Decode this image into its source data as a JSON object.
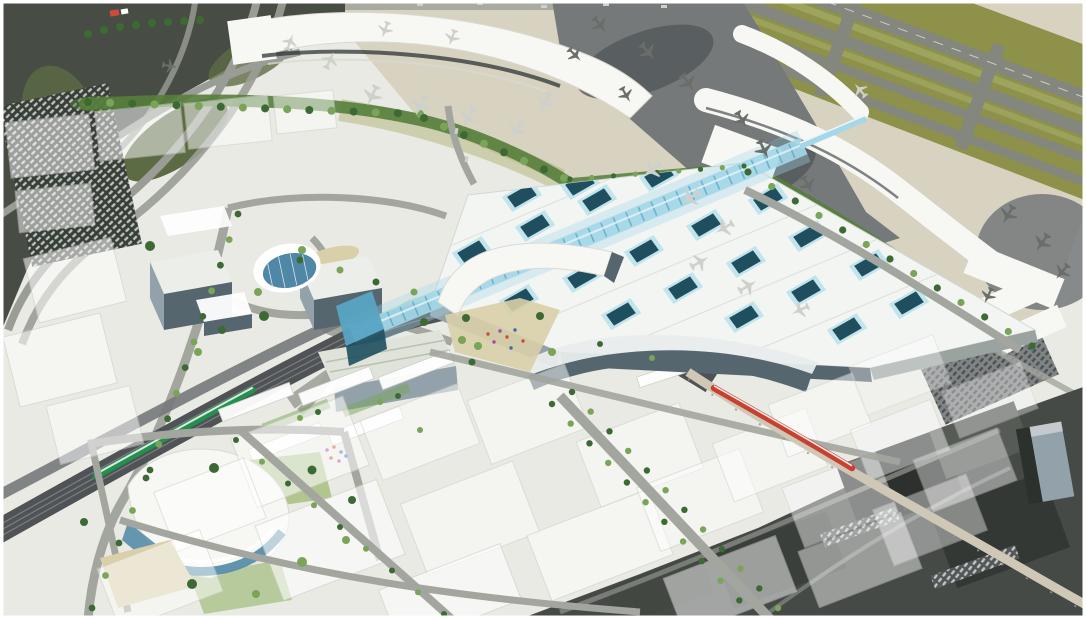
{
  "meta": {
    "description": "Aerial architectural rendering of an airport district: existing terminal piers, apron and runways across the top, a new white transit hall with a diagonal blue glass galleria spine and skylights at centre, an office campus with a round glass building at left, a rail corridor with a green commuter train and an elevated guideway with a red airport train, a curved civic landmark building at lower left, translucent future-development massing blocks and tree-lined streets below, and a darker existing industrial area photo at lower right."
  },
  "palette": {
    "photoBase": "#474c44",
    "photoRoad": "#9a9d95",
    "photoGrass": "#5d6b45",
    "photoLot": "#383e38",
    "apron": "#d8d2c0",
    "photoApron": "#75797a",
    "photoApronDark": "#53575a",
    "terminalWhite": "#f7f7f3",
    "terminalShade": "#d9dad2",
    "glassBand": "#2e3437",
    "planeLight": "#ced1cb",
    "planeDark": "#696e6a",
    "runwayGray": "#84877d",
    "runwayGrass": "#8d9149",
    "devBase": "#e9eae4",
    "roadGray": "#a3a59f",
    "railBed": "#4f5356",
    "trackLine": "#83878a",
    "greenTrain": "#21914e",
    "redTrain": "#c8402f",
    "guideway": "#cfc8b6",
    "roofWhite": "#f3f5f3",
    "skylightDark": "#1f4f5f",
    "skylightRim": "#c2e4ec",
    "glassSpine": "#a4d7e8",
    "glassSpineDark": "#58a4c3",
    "facadeDark": "#55666f",
    "facadeLight": "#93a2aa",
    "kidneyGlass": "#4f87a6",
    "treeDark": "#3d6a34",
    "treeLight": "#7aa458",
    "hedge": "#567e3b",
    "plazaTan": "#d9cfa9",
    "massingEdge": "#cdd0c8",
    "photoBR": "#454a46",
    "photoBRdark": "#2c312d",
    "peopleA": "#a8489d",
    "peopleB": "#cf4b39",
    "peopleC": "#4a62b0",
    "white": "#ffffff"
  },
  "scene": {
    "regions": [
      "existing-airport-photo-northwest",
      "highway-interchange",
      "airport-apron",
      "main-terminal-pier",
      "east-terminal-pier",
      "parked-aircraft",
      "runways-and-taxiways",
      "green-buffer-trees",
      "transit-hall-roof",
      "glass-galleria-spine",
      "roof-skylights",
      "office-campus",
      "round-glass-building",
      "rail-corridor",
      "green-commuter-train",
      "red-airport-train",
      "elevated-guideway",
      "civic-landmark-building",
      "future-development-massing-blocks",
      "tree-lined-streets",
      "industrial-area-photo-southeast"
    ]
  }
}
